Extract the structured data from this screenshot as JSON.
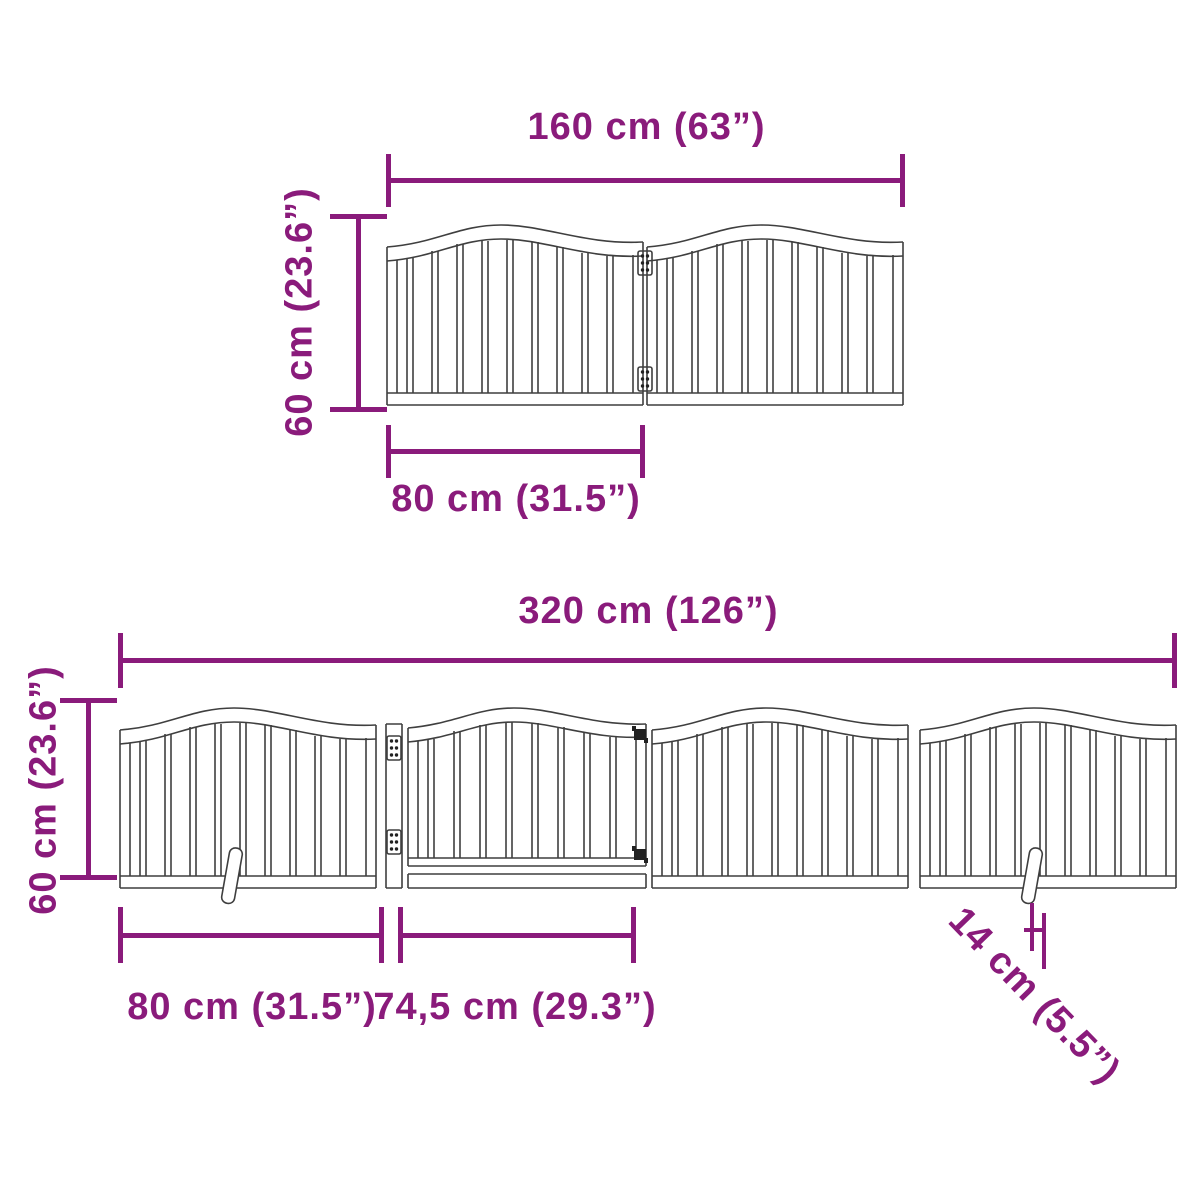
{
  "colors": {
    "accent": "#8a1b7b",
    "drawing_line": "#3f3f3f",
    "background": "#ffffff"
  },
  "top_diagram": {
    "description": "two-panel folding pet gate, front view",
    "total_width_label": "160 cm (63”)",
    "height_label": "60 cm (23.6”)",
    "panel_width_label": "80 cm (31.5”)"
  },
  "bottom_diagram": {
    "description": "four-panel folding pet gate with door and support feet, front view",
    "total_width_label": "320 cm (126”)",
    "height_label": "60 cm (23.6”)",
    "panel_width_label": "80 cm (31.5”)",
    "door_width_label": "74,5 cm (29.3”)",
    "foot_depth_label": "14 cm (5.5”)"
  }
}
